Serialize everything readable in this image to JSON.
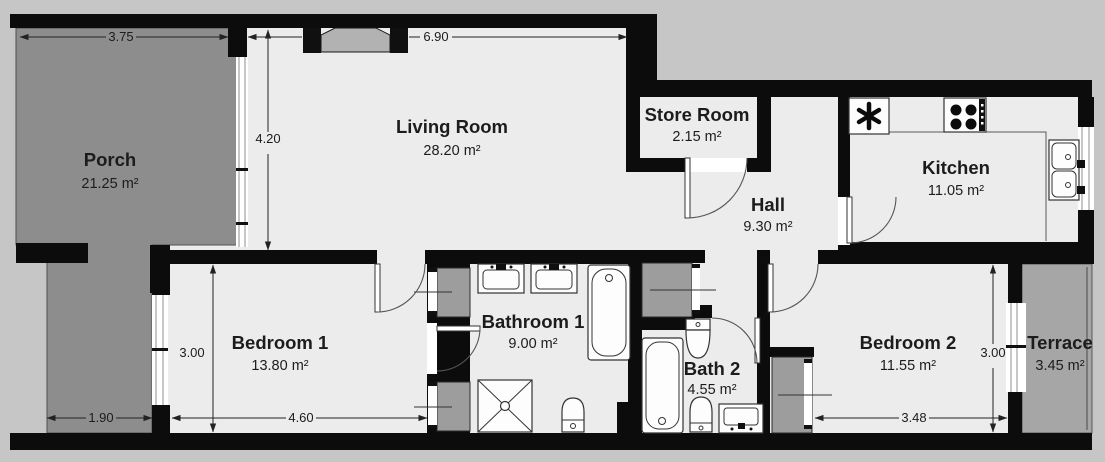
{
  "rooms": {
    "porch": {
      "name": "Porch",
      "area": "21.25 m²"
    },
    "living_room": {
      "name": "Living Room",
      "area": "28.20 m²"
    },
    "store_room": {
      "name": "Store Room",
      "area": "2.15 m²"
    },
    "hall": {
      "name": "Hall",
      "area": "9.30 m²"
    },
    "kitchen": {
      "name": "Kitchen",
      "area": "11.05 m²"
    },
    "bedroom_1": {
      "name": "Bedroom 1",
      "area": "13.80 m²"
    },
    "bathroom_1": {
      "name": "Bathroom 1",
      "area": "9.00 m²"
    },
    "bath_2": {
      "name": "Bath 2",
      "area": "4.55 m²"
    },
    "bedroom_2": {
      "name": "Bedroom 2",
      "area": "11.55 m²"
    },
    "terrace": {
      "name": "Terrace",
      "area": "3.45 m²"
    }
  },
  "dimensions": {
    "porch_width": "3.75",
    "living_room_width": "6.90",
    "living_room_depth": "4.20",
    "bedroom_1_depth": "3.00",
    "porch_passage_width": "1.90",
    "bedroom_1_width": "4.60",
    "bedroom_2_width": "3.48",
    "bedroom_2_depth": "3.00"
  },
  "colors": {
    "wall": "#0c0c0c",
    "floor": "#ececec",
    "porch": "#8d8d8d",
    "terrace": "#a6a6a6",
    "closet": "#9d9d9d",
    "background": "#c6c6c6",
    "fixture": "#fdfdfd",
    "text": "#1c1c1c"
  }
}
